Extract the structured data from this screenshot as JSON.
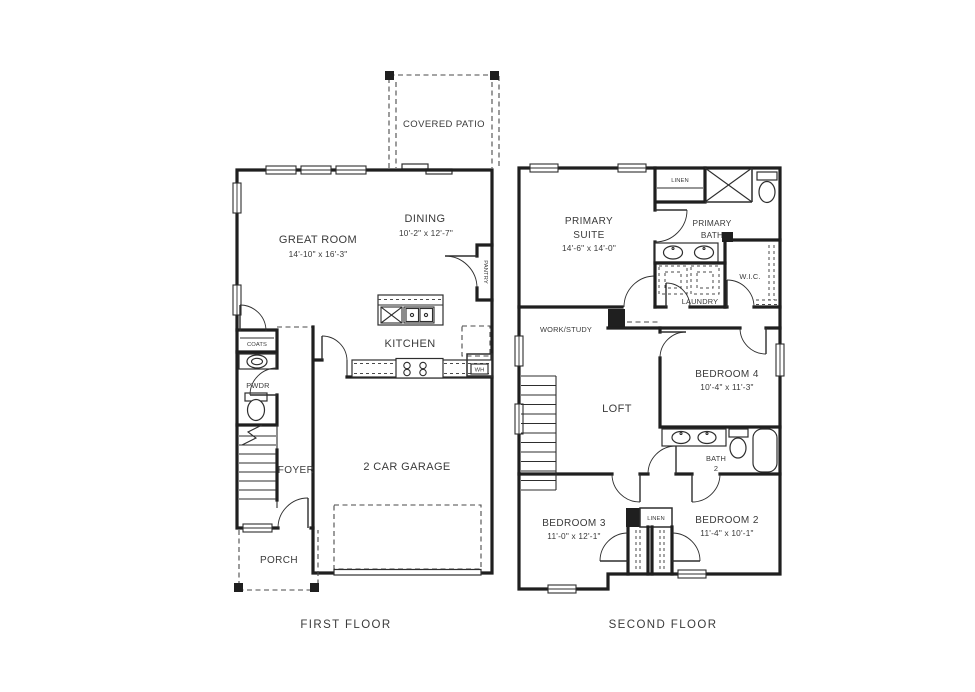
{
  "colors": {
    "wall": "#1f1f1f",
    "fixture": "#2e2e2e",
    "dashed": "#4a4a4a",
    "text": "#3a3a3a",
    "background": "#ffffff"
  },
  "first_floor": {
    "label": "FIRST FLOOR",
    "covered_patio": "COVERED PATIO",
    "great_room": "GREAT ROOM",
    "great_room_dims": "14'-10\" x 16'-3\"",
    "dining": "DINING",
    "dining_dims": "10'-2\" x 12'-7\"",
    "kitchen": "KITCHEN",
    "pantry": "PANTRY",
    "coats": "COATS",
    "pwdr": "PWDR",
    "foyer": "FOYER",
    "garage": "2 CAR GARAGE",
    "porch": "PORCH",
    "water_heater": "WH"
  },
  "second_floor": {
    "label": "SECOND FLOOR",
    "primary_suite_line1": "PRIMARY",
    "primary_suite_line2": "SUITE",
    "primary_suite_dims": "14'-6\" x 14'-0\"",
    "linen_upper": "LINEN",
    "primary_bath_line1": "PRIMARY",
    "primary_bath_line2": "BATH",
    "wic": "W.I.C.",
    "laundry": "LAUNDRY",
    "work_study": "WORK/STUDY",
    "loft": "LOFT",
    "bedroom4": "BEDROOM 4",
    "bedroom4_dims": "10'-4\" x 11'-3\"",
    "bath2_line1": "BATH",
    "bath2_line2": "2",
    "bedroom3": "BEDROOM 3",
    "bedroom3_dims": "11'-0\" x 12'-1\"",
    "bedroom2": "BEDROOM 2",
    "bedroom2_dims": "11'-4\" x 10'-1\"",
    "linen_lower": "LINEN"
  }
}
